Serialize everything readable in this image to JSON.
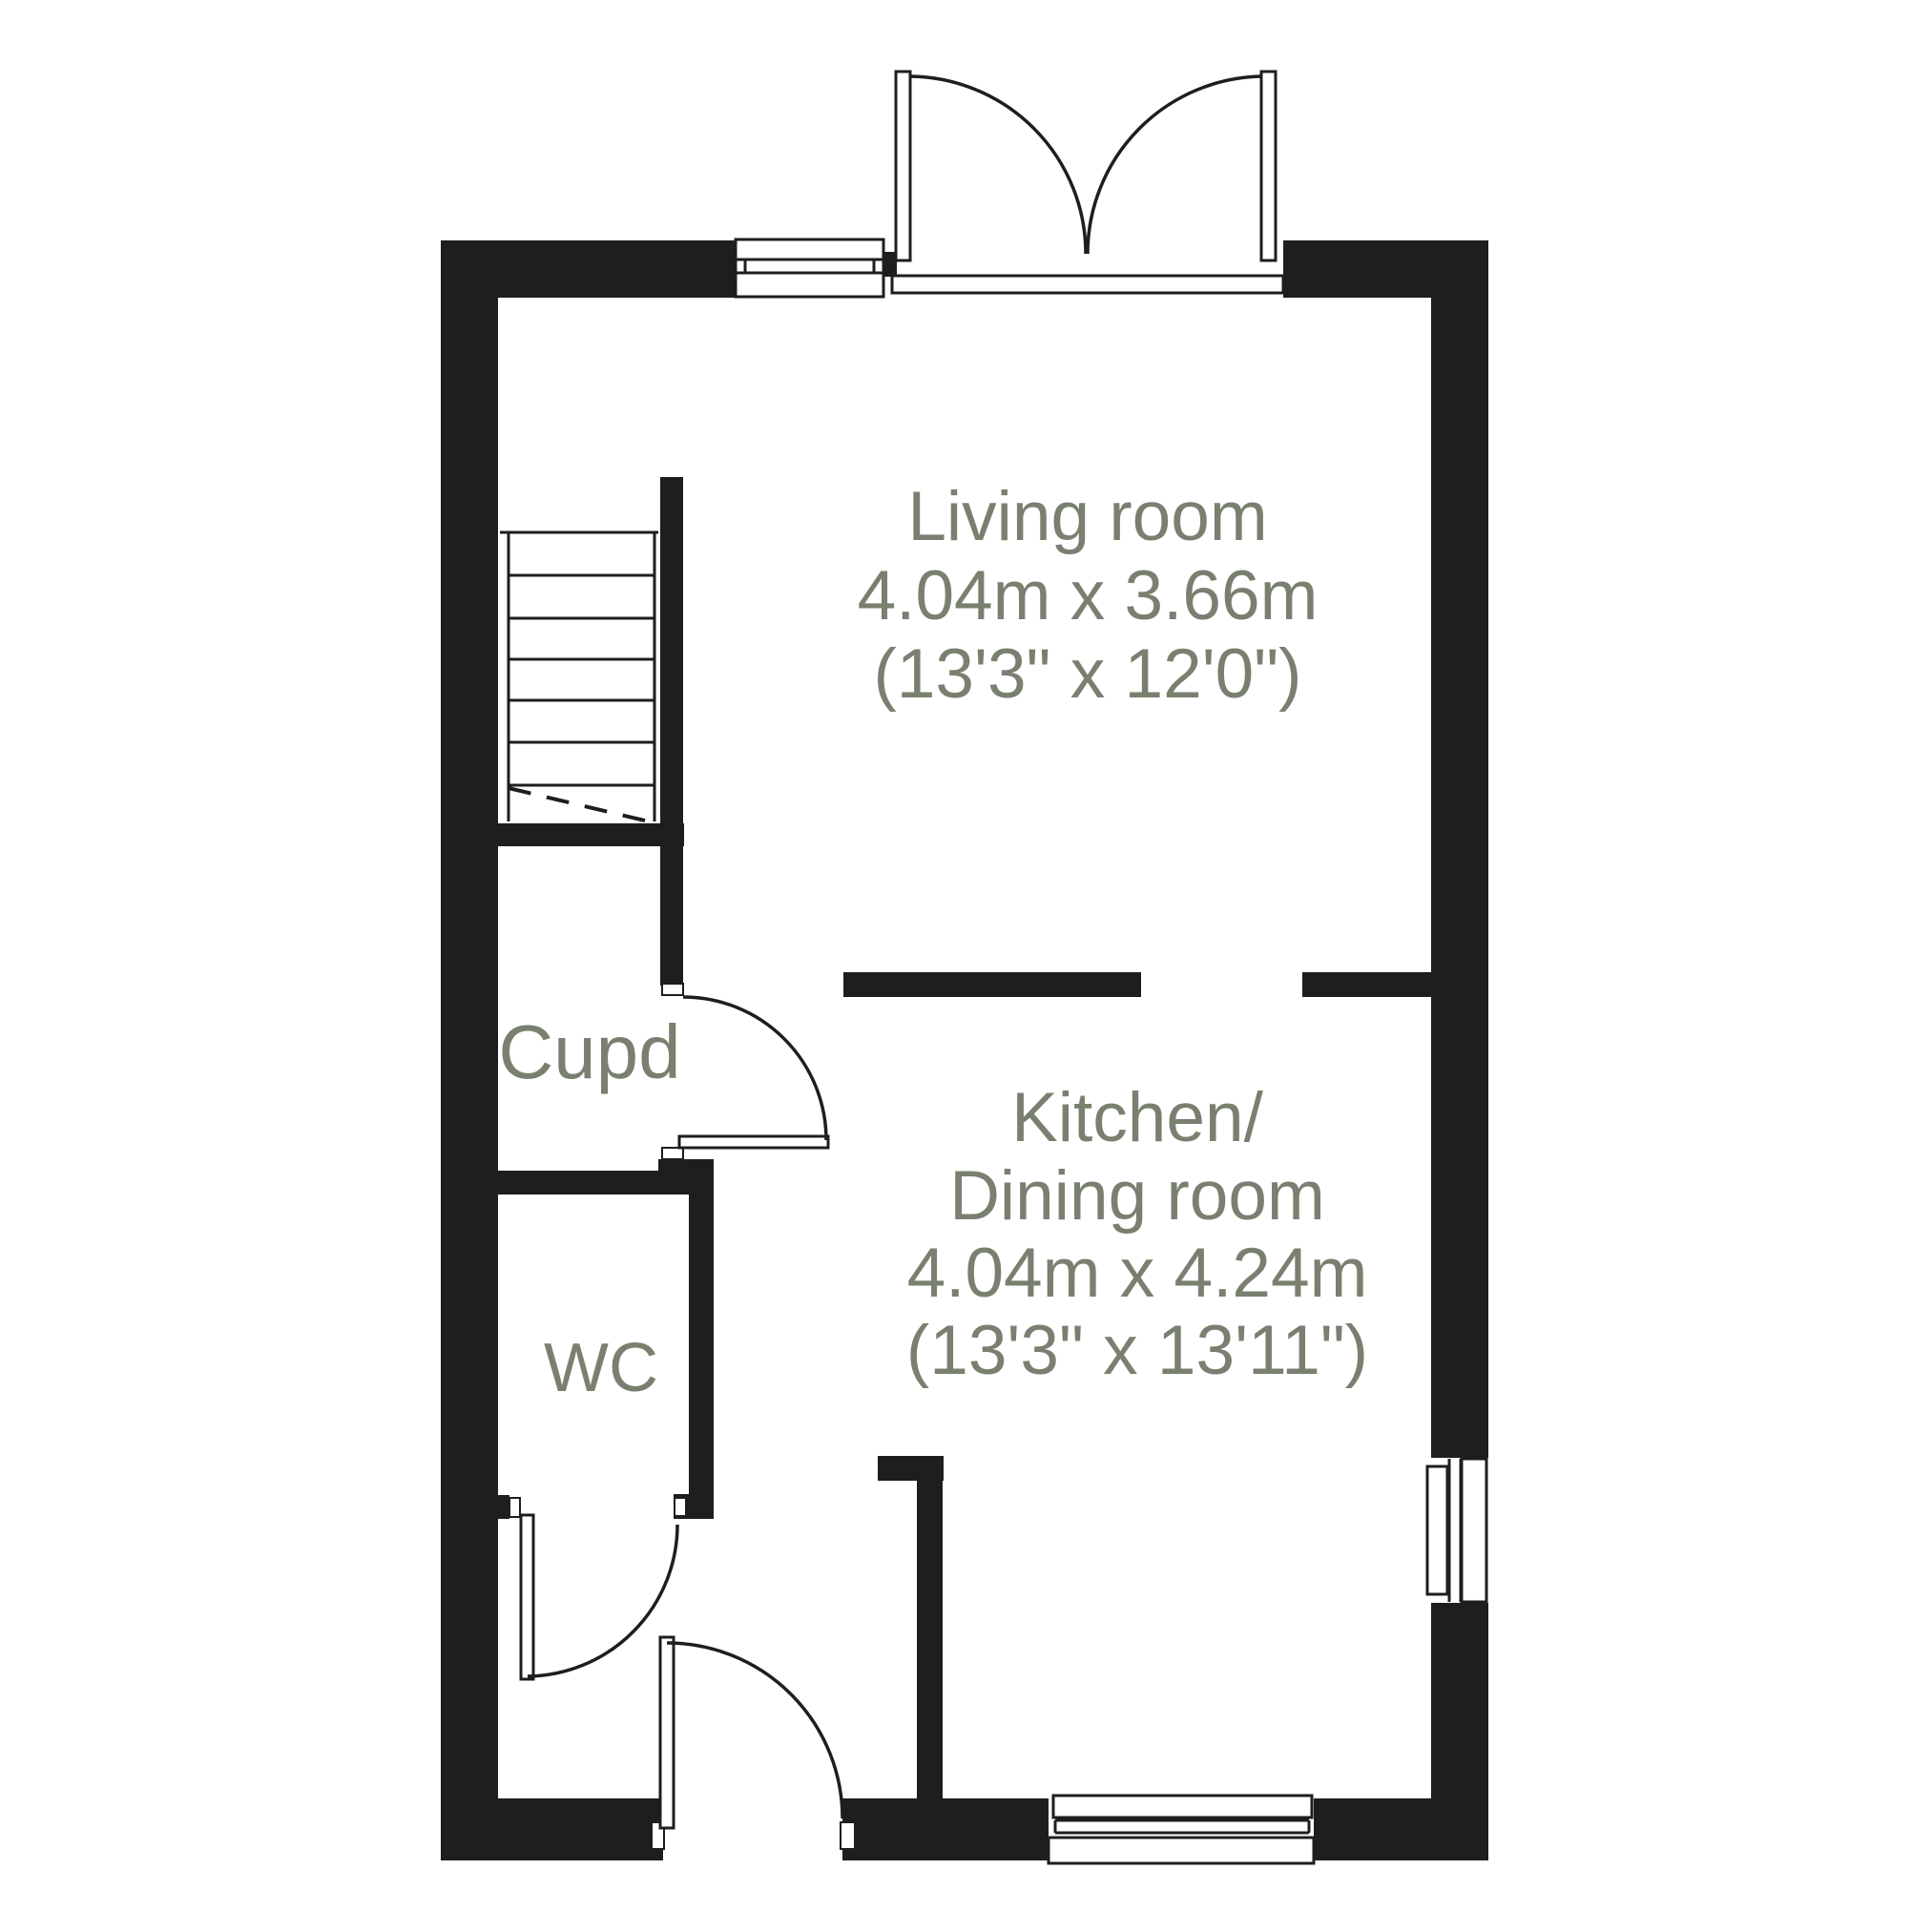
{
  "plan": {
    "type": "floor-plan",
    "colors": {
      "wall": "#1e1e1c",
      "line": "#1e1e1c",
      "label_text": "#798070",
      "background": "#ffffff"
    },
    "rooms": {
      "living": {
        "name": "Living room",
        "dims_metric": "4.04m x 3.66m",
        "dims_imperial": "(13'3\" x 12'0\")"
      },
      "kitchen": {
        "name_line1": "Kitchen/",
        "name_line2": "Dining room",
        "dims_metric": "4.04m x 4.24m",
        "dims_imperial": "(13'3\" x 13'11\")"
      },
      "cupboard": {
        "name": "Cupd"
      },
      "wc": {
        "name": "WC"
      }
    },
    "features": {
      "stairs": "staircase with 6 treads and dashed under-stair line",
      "doors": [
        "french-doors-top",
        "front-door-bottom",
        "wc-door",
        "cupboard-door"
      ],
      "windows": [
        "top-wall-window",
        "right-wall-window",
        "bottom-wall-window"
      ]
    }
  }
}
